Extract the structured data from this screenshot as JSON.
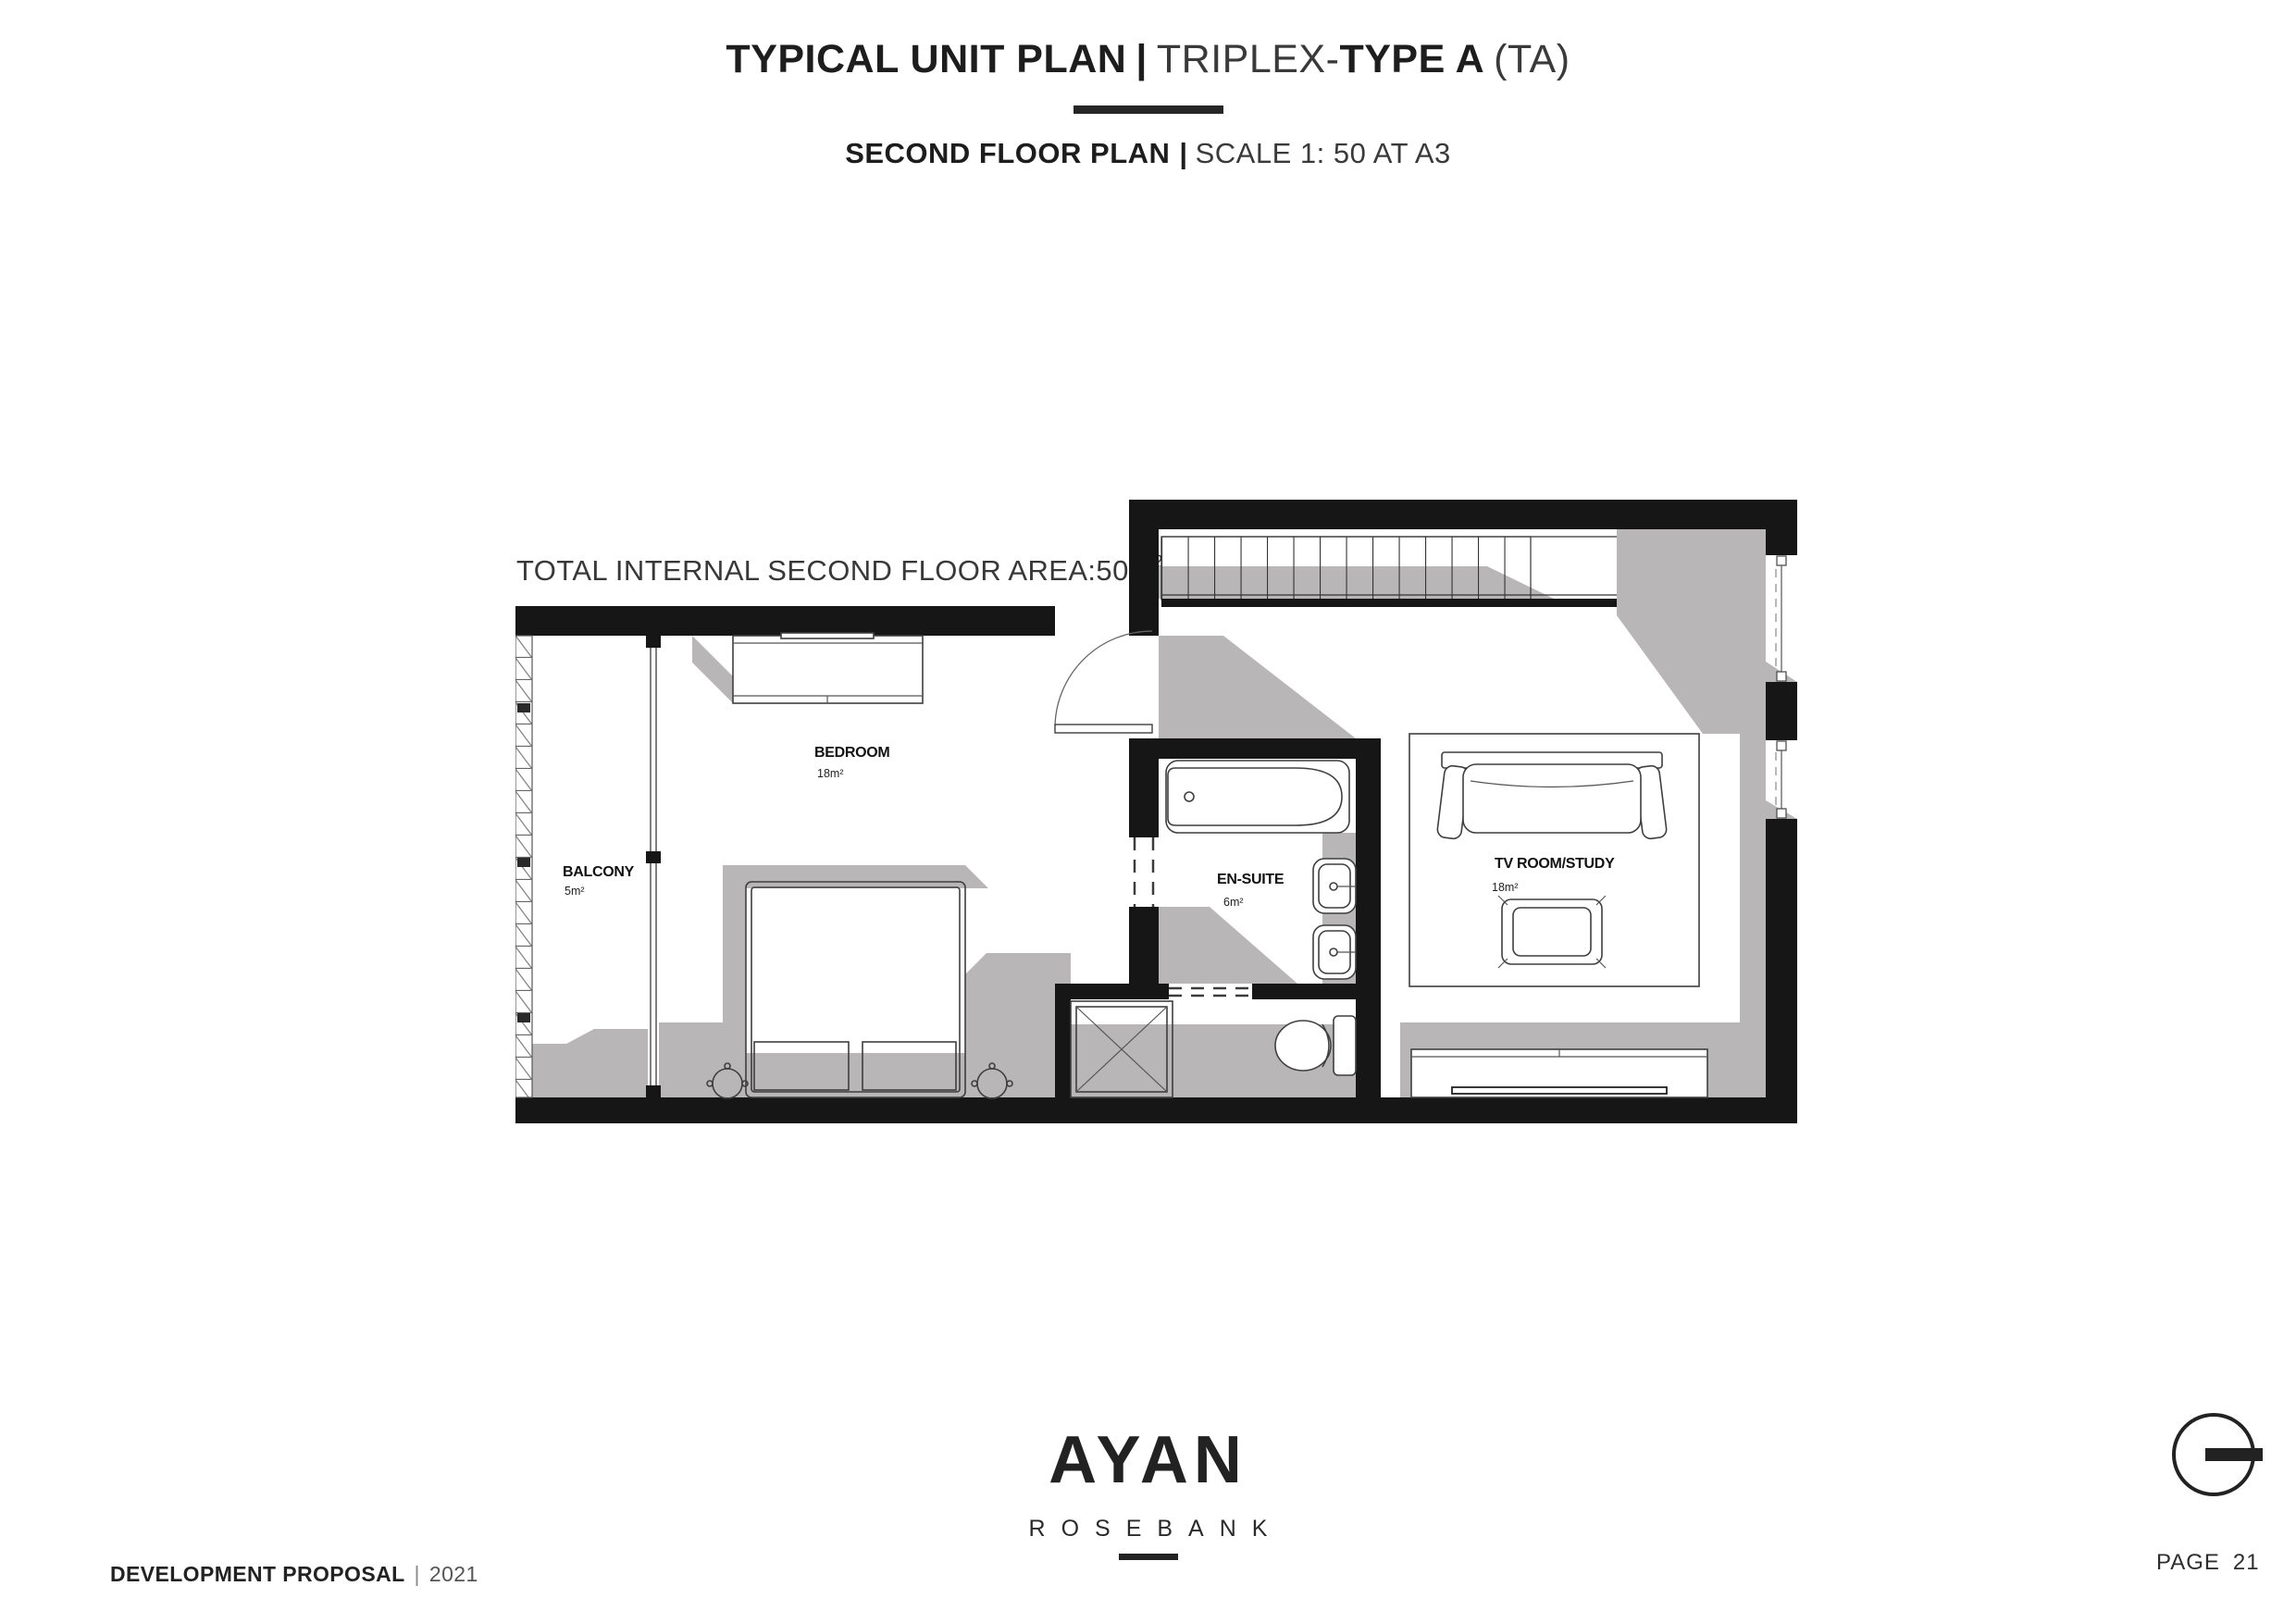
{
  "header": {
    "title_main": "TYPICAL UNIT PLAN",
    "title_sep": "|",
    "title_type_prefix": "TRIPLEX-",
    "title_type": "TYPE A",
    "title_suffix": "(TA)",
    "subtitle_main": "SECOND FLOOR PLAN",
    "subtitle_sep": "|",
    "subtitle_scale": "SCALE 1: 50 AT A3"
  },
  "annotation": {
    "total_area_label": "TOTAL INTERNAL SECOND FLOOR AREA:50m",
    "total_area_sup": "2"
  },
  "plan": {
    "rooms": [
      {
        "name": "BALCONY",
        "area": "5m²"
      },
      {
        "name": "BEDROOM",
        "area": "18m²"
      },
      {
        "name": "EN-SUITE",
        "area": "6m²"
      },
      {
        "name": "TV ROOM/STUDY",
        "area": "18m²"
      }
    ]
  },
  "footer": {
    "doc_title": "DEVELOPMENT PROPOSAL",
    "separator": "|",
    "year": "2021",
    "logo_text": "AYAN",
    "logo_subtext": "ROSEBANK",
    "page_label": "PAGE",
    "page_number": "21"
  },
  "colors": {
    "wall": "#161616",
    "floor_shadow": "#b9b6b8",
    "text_dark": "#1d1d1d",
    "text_light": "#3a3a3a"
  }
}
